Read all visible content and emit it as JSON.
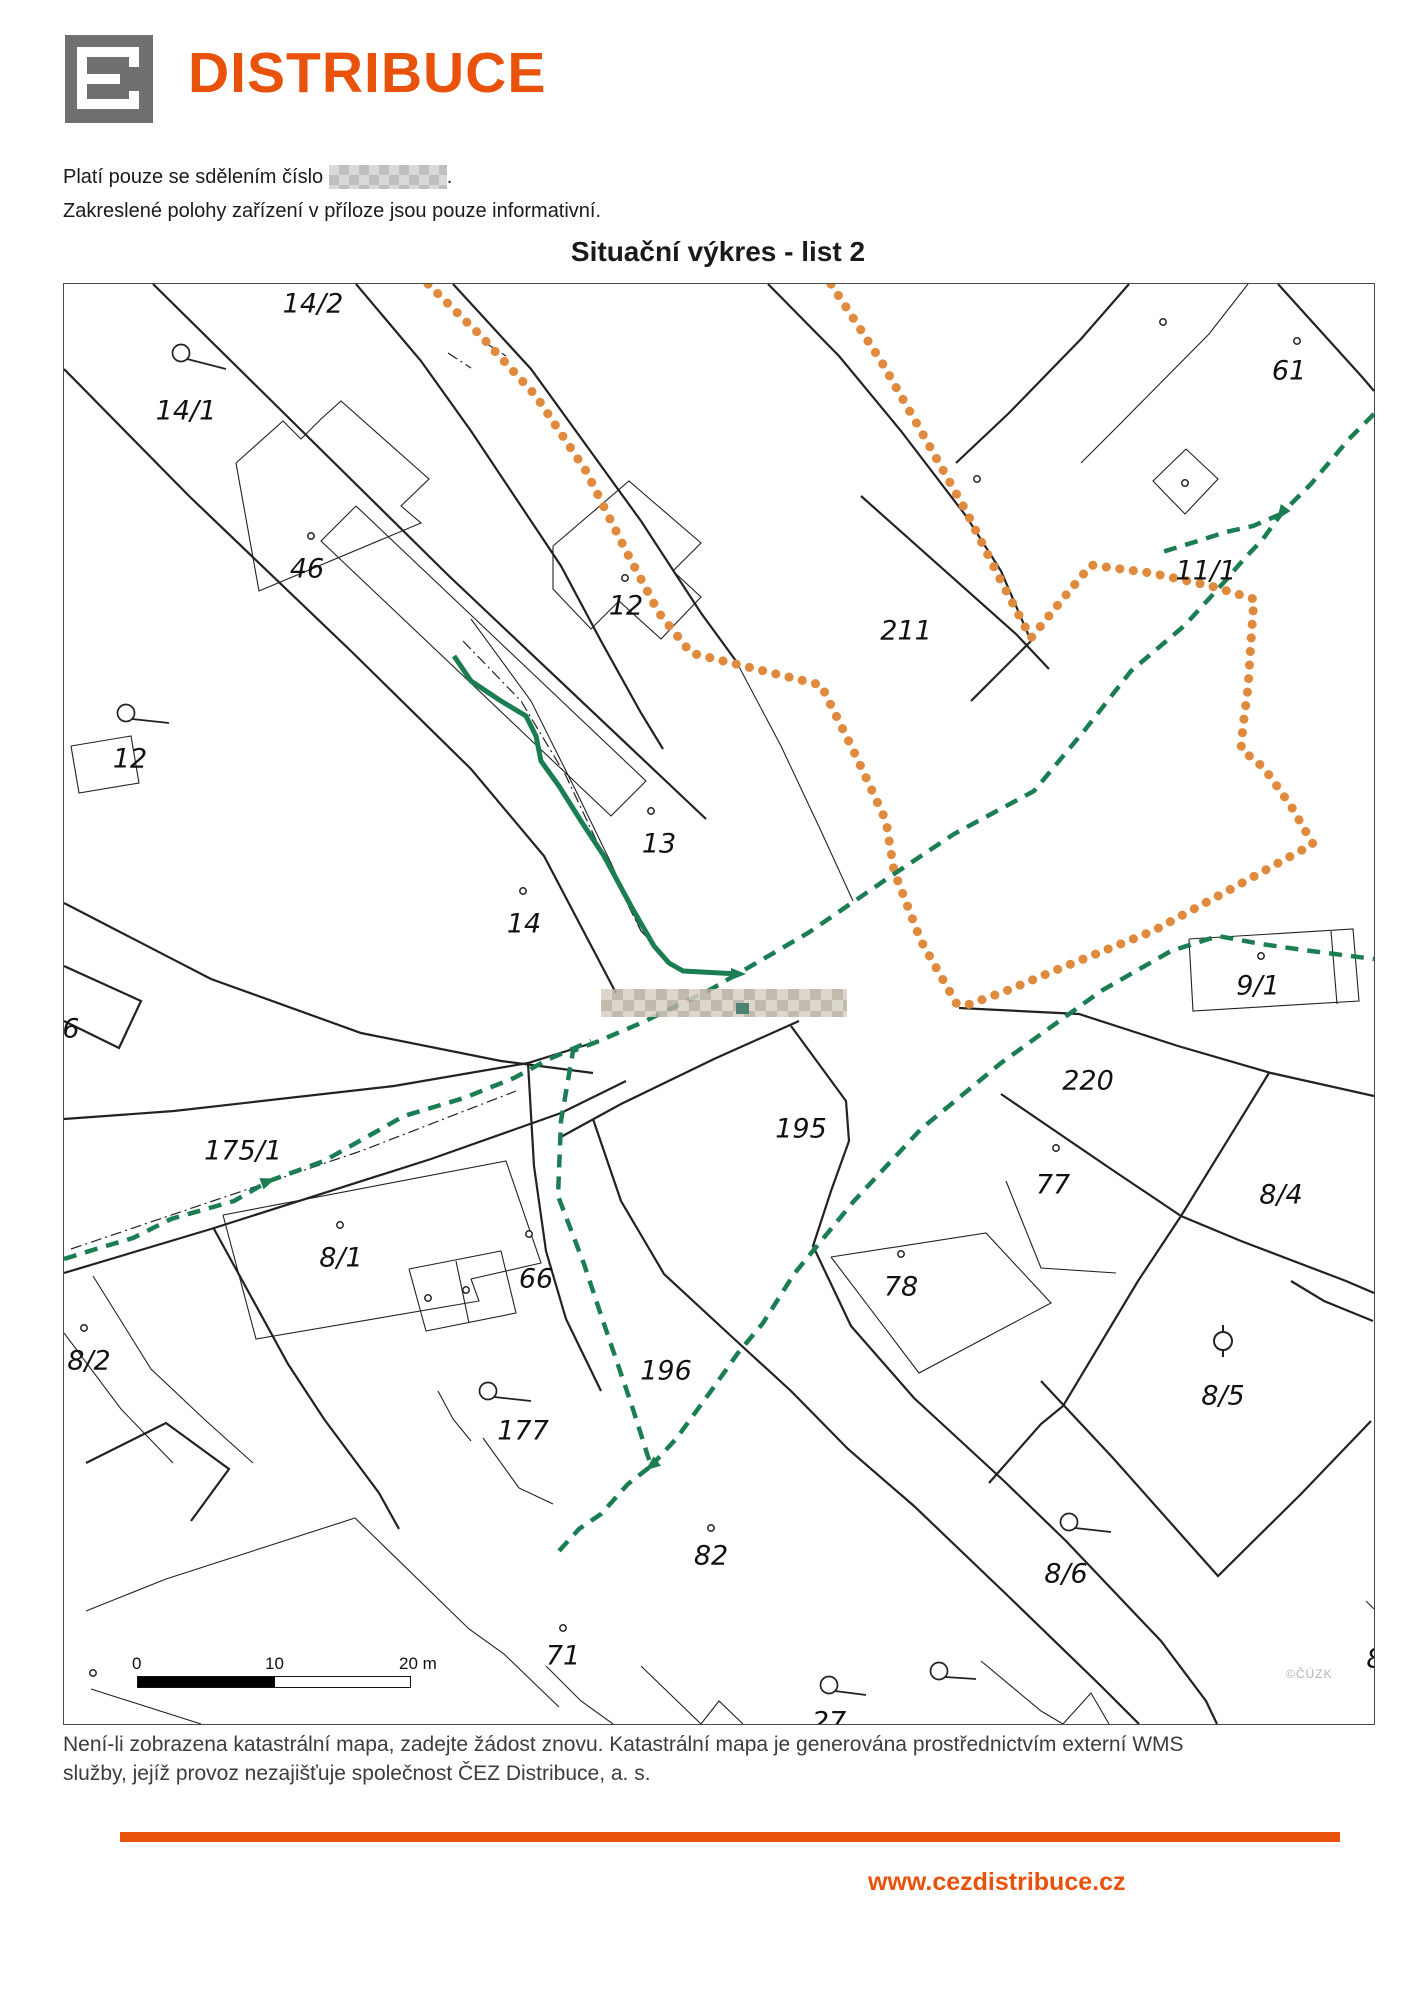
{
  "header": {
    "brand": "DISTRIBUCE",
    "note1_prefix": "Platí pouze se sdělením číslo",
    "note1_suffix": ".",
    "note2": "Zakreslené polohy zařízení v příloze jsou pouze informativní.",
    "title": "Situační výkres - list 2"
  },
  "colors": {
    "accent": "#E8520A",
    "orange_line": "#E08A3E",
    "green_line": "#1B7D52",
    "black_line": "#222222"
  },
  "map": {
    "labels": [
      {
        "text": "14/2",
        "x": 312,
        "y": 303
      },
      {
        "text": "14/1",
        "x": 185,
        "y": 410
      },
      {
        "text": "46",
        "x": 306,
        "y": 568
      },
      {
        "text": "12",
        "x": 129,
        "y": 758
      },
      {
        "text": "12",
        "x": 625,
        "y": 605
      },
      {
        "text": "13",
        "x": 658,
        "y": 843
      },
      {
        "text": "14",
        "x": 523,
        "y": 923
      },
      {
        "text": "211",
        "x": 905,
        "y": 630
      },
      {
        "text": "61",
        "x": 1288,
        "y": 370
      },
      {
        "text": "11/1",
        "x": 1205,
        "y": 570
      },
      {
        "text": "9/1",
        "x": 1257,
        "y": 985
      },
      {
        "text": "220",
        "x": 1087,
        "y": 1080
      },
      {
        "text": "77",
        "x": 1052,
        "y": 1184
      },
      {
        "text": "8/4",
        "x": 1280,
        "y": 1194
      },
      {
        "text": "195",
        "x": 800,
        "y": 1128
      },
      {
        "text": "175/1",
        "x": 242,
        "y": 1150
      },
      {
        "text": "6",
        "x": 70,
        "y": 1028
      },
      {
        "text": "8/1",
        "x": 340,
        "y": 1257
      },
      {
        "text": "66",
        "x": 535,
        "y": 1278
      },
      {
        "text": "8/2",
        "x": 88,
        "y": 1360
      },
      {
        "text": "177",
        "x": 522,
        "y": 1430
      },
      {
        "text": "196",
        "x": 665,
        "y": 1370
      },
      {
        "text": "78",
        "x": 900,
        "y": 1286
      },
      {
        "text": "82",
        "x": 710,
        "y": 1555
      },
      {
        "text": "71",
        "x": 562,
        "y": 1655
      },
      {
        "text": "8/5",
        "x": 1222,
        "y": 1395
      },
      {
        "text": "8/6",
        "x": 1065,
        "y": 1573
      },
      {
        "text": "8",
        "x": 1374,
        "y": 1658
      },
      {
        "text": "27",
        "x": 828,
        "y": 1721
      }
    ],
    "lines": {
      "black_thick": [
        "152,283 448,575 705,818",
        "63,368 188,495 352,652 470,768 543,855 615,992",
        "355,283 420,360 470,430 520,505 560,565 600,640 640,712 662,748",
        "452,283 530,368 640,520 700,612 735,660",
        "767,283 838,355 900,430 965,515 1000,570 1030,640",
        "1030,640 970,700",
        "860,495 1015,633 1048,668",
        "1128,283 1080,338 1008,412 955,462",
        "1277,283 1362,377 1373,390",
        "958,1007 1078,1013 1177,1045 1270,1072 1373,1095",
        "1000,1093 1110,1168 1180,1215 1240,1240 1345,1280 1373,1292",
        "1268,1072 1180,1215",
        "1180,1215 1137,1280 1062,1405 1040,1423 988,1482",
        "1040,1380 1112,1457 1192,1547 1217,1575 1300,1493 1370,1420",
        "1290,1280 1323,1300 1372,1320",
        "63,1118 173,1110 393,1085 527,1062 598,1040",
        "63,1272 210,1228 430,1158 560,1112 625,1080",
        "213,1228 287,1363 323,1418 378,1492 398,1528",
        "592,1118 620,1200 663,1273 730,1335 790,1390 847,1448 913,1505 1005,1593 1100,1685 1138,1723",
        "790,1025 845,1100 848,1140 830,1190 812,1245 850,1325 913,1397 1003,1480 1065,1540 1160,1640 1205,1700 1216,1723",
        "558,1137 620,1103 713,1058 798,1020",
        "63,902 210,978 360,1032 500,1060 592,1072",
        "527,1062 533,1165 545,1250 565,1318 600,1390",
        "85,1462 165,1422 228,1468 190,1520",
        "63,965 140,1000 118,1047 63,1020"
      ],
      "black_thin": [
        "470,618 530,700 575,790 610,862 640,930 668,960",
        "735,660 780,745 820,830 852,900",
        "1247,283 1208,333 1117,425 1080,462",
        "1185,448 1217,478 1184,513 1152,480 1185,448",
        "1188,938 1352,928 1358,1000 1192,1010 1188,938",
        "1330,930 1336,1003",
        "222,1214 505,1160 540,1262 470,1278 478,1300 255,1338 222,1214",
        "408,1268 500,1250 515,1312 425,1330 408,1268",
        "455,1260 468,1322",
        "92,1275 150,1368 203,1418 252,1462",
        "63,1332 120,1408 172,1462",
        "830,1256 985,1232 1050,1302 918,1372 830,1256",
        "85,1610 165,1578 354,1517 468,1628 503,1653 558,1706",
        "235,462 282,420 300,438 320,418 340,400 428,478 400,505 420,522 258,590 235,462",
        "355,505 645,780 610,815 320,540 355,505",
        "552,545 628,480 700,542 672,570 700,596 660,638 618,600 590,628 552,588 552,545",
        "70,745 130,735 138,782 78,792 70,745",
        "1005,1180 1040,1267 1115,1272",
        "482,1437 518,1487 552,1503",
        "437,1390 452,1418 470,1440",
        "545,1665 580,1700 612,1723",
        "640,1665 700,1723 718,1700 742,1723",
        "980,1660 1040,1710 1062,1723 1090,1692 1108,1723",
        "1365,1600 1373,1608",
        "90,1688 200,1723"
      ],
      "dashdot": [
        "462,640 520,700 565,775 605,860 640,930 670,962",
        "70,1248 200,1204 360,1150 515,1090",
        "447,352 470,367",
        "483,341 505,355"
      ],
      "orange_dotted": [
        "427,283 480,335 535,395 585,470 625,550 658,612 690,652 755,668 820,684 855,755 885,820 893,870 920,940 958,1007",
        "830,283 880,360 920,430 965,510 1000,580 1030,637 1060,600 1090,564 1150,572 1210,585 1253,598 1250,640 1247,687 1242,725 1240,748 1263,767 1290,805 1312,843 1230,888 1152,930 1060,967 1005,990 958,1007"
      ],
      "green_solid": [
        "453,655 470,680 500,700 525,715 535,735 540,760 558,785 580,820 603,855 630,905 653,945 668,962 682,970 738,973"
      ],
      "green_dashed": [
        "1373,413 1348,438 1310,483 1280,513 1262,538 1243,558 1225,579 1206,600 1183,625 1130,670 1083,730 1033,790 953,833 890,875 807,932 707,990 640,1022 598,1040 572,1050 560,1120 557,1195 583,1263 602,1320 630,1402 650,1465 627,1483 600,1513 578,1528 558,1550",
        "1280,513 1252,525 1225,531 1197,540 1158,552",
        "650,1465 675,1438 710,1390 737,1352 762,1322 793,1273 853,1200 920,1128 1000,1062 1100,990 1170,950 1217,935 1260,943 1310,950 1373,958",
        "63,1258 95,1248 132,1237 170,1218 233,1200 268,1180 323,1160 403,1115 463,1097 513,1077 548,1058 590,1040"
      ]
    },
    "arrows": [
      {
        "x": 738,
        "y": 973,
        "a": 0
      },
      {
        "x": 1280,
        "y": 513,
        "a": 126
      },
      {
        "x": 268,
        "y": 1180,
        "a": -20
      },
      {
        "x": 650,
        "y": 1465,
        "a": 142
      }
    ],
    "dot_markers": [
      [
        624,
        577
      ],
      [
        650,
        810
      ],
      [
        522,
        890
      ],
      [
        310,
        535
      ],
      [
        976,
        478
      ],
      [
        1162,
        321
      ],
      [
        1296,
        340
      ],
      [
        1184,
        482
      ],
      [
        1055,
        1147
      ],
      [
        339,
        1224
      ],
      [
        528,
        1233
      ],
      [
        427,
        1297
      ],
      [
        465,
        1289
      ],
      [
        83,
        1327
      ],
      [
        900,
        1253
      ],
      [
        710,
        1527
      ],
      [
        562,
        1627
      ],
      [
        92,
        1672
      ],
      [
        1260,
        955
      ]
    ],
    "well_symbols": [
      {
        "x": 180,
        "y": 352,
        "tx": 225,
        "ty": 368
      },
      {
        "x": 125,
        "y": 712,
        "tx": 168,
        "ty": 722
      },
      {
        "x": 487,
        "y": 1390,
        "tx": 530,
        "ty": 1400
      },
      {
        "x": 1068,
        "y": 1521,
        "tx": 1110,
        "ty": 1531
      },
      {
        "x": 828,
        "y": 1684,
        "tx": 865,
        "ty": 1694
      },
      {
        "x": 938,
        "y": 1670,
        "tx": 975,
        "ty": 1678
      }
    ],
    "lamp_symbol": {
      "x": 1222,
      "y": 1340
    },
    "redacted_area": {
      "x": 600,
      "y": 988,
      "w": 246,
      "h": 28
    },
    "scale_bar": {
      "t0": "0",
      "t10": "10",
      "t20": "20 m"
    },
    "watermark": "©ČÚZK"
  },
  "footer": {
    "line1": "Není-li zobrazena katastrální mapa, zadejte žádost znovu. Katastrální mapa je generována prostřednictvím externí WMS",
    "line2": "služby, jejíž provoz nezajišťuje společnost ČEZ Distribuce, a. s.",
    "url": "www.cezdistribuce.cz"
  }
}
